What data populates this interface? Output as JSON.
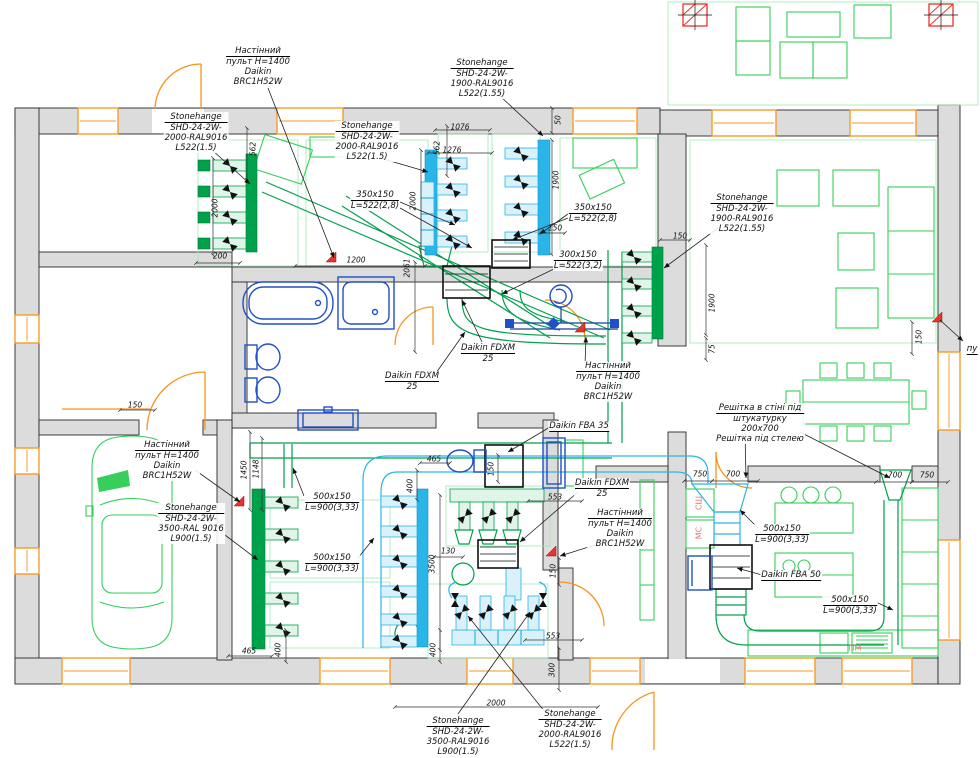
{
  "drawing": {
    "type": "hvac-floor-plan",
    "colors": {
      "wall": "#dcdcdc",
      "duct_green": "#00a14b",
      "furniture_green": "#35cf5a",
      "duct_cyan": "#2ab5e8",
      "sanitary_blue": "#2050c8",
      "window_orange": "#f7941d",
      "marker_red": "#e8342a",
      "label_pink": "#e87070"
    },
    "callouts": [
      {
        "x": 258,
        "y": 46,
        "lines": [
          "Настінний",
          "пульт H=1400",
          "Daikin",
          "BRC1H52W"
        ]
      },
      {
        "x": 196,
        "y": 112,
        "lines": [
          "Stonehange",
          "SHD-24-2W-",
          "2000-RAL9016",
          "L522(1.5)"
        ]
      },
      {
        "x": 367,
        "y": 121,
        "lines": [
          "Stonehange",
          "SHD-24-2W-",
          "2000-RAL9016",
          "L522(1.5)"
        ]
      },
      {
        "x": 482,
        "y": 58,
        "lines": [
          "Stonehange",
          "SHD-24-2W-",
          "1900-RAL9016",
          "L522(1.55)"
        ]
      },
      {
        "x": 375,
        "y": 190,
        "lines": [
          "350x150",
          "L=522(2,8)"
        ]
      },
      {
        "x": 742,
        "y": 193,
        "lines": [
          "Stonehange",
          "SHD-24-2W-",
          "1900-RAL9016",
          "L522(1.55)"
        ]
      },
      {
        "x": 593,
        "y": 203,
        "lines": [
          "350x150",
          "L=522(2,8)"
        ]
      },
      {
        "x": 578,
        "y": 250,
        "lines": [
          "300x150",
          "L=522(3,2)"
        ]
      },
      {
        "x": 488,
        "y": 343,
        "lines": [
          "Daikin FDXM",
          "25"
        ]
      },
      {
        "x": 412,
        "y": 371,
        "lines": [
          "Daikin FDXM",
          "25"
        ]
      },
      {
        "x": 608,
        "y": 361,
        "lines": [
          "Настінний",
          "пульт H=1400",
          "Daikin",
          "BRC1H52W"
        ]
      },
      {
        "x": 760,
        "y": 403,
        "lines": [
          "Решітка в стіні під",
          "штукатурку",
          "200х700",
          "Решітка під стелею"
        ]
      },
      {
        "x": 579,
        "y": 421,
        "lines": [
          "Daikin FBA 35"
        ]
      },
      {
        "x": 602,
        "y": 478,
        "lines": [
          "Daikin FDXM",
          "25"
        ]
      },
      {
        "x": 620,
        "y": 508,
        "lines": [
          "Настінний",
          "пульт H=1400",
          "Daikin",
          "BRC1H52W"
        ]
      },
      {
        "x": 167,
        "y": 440,
        "lines": [
          "Настінний",
          "пульт H=1400",
          "Daikin",
          "BRC1H52W"
        ]
      },
      {
        "x": 191,
        "y": 503,
        "lines": [
          "Stonehange",
          "SHD-24-2W-",
          "3500-RAL 9016",
          "L900(1.5)"
        ]
      },
      {
        "x": 332,
        "y": 492,
        "lines": [
          "500x150",
          "L=900(3,33)"
        ]
      },
      {
        "x": 332,
        "y": 553,
        "lines": [
          "500x150",
          "L=900(3,33)"
        ]
      },
      {
        "x": 782,
        "y": 524,
        "lines": [
          "500x150",
          "L=900(3,33)"
        ]
      },
      {
        "x": 791,
        "y": 570,
        "lines": [
          "Daikin FBA 50"
        ]
      },
      {
        "x": 850,
        "y": 595,
        "lines": [
          "500x150",
          "L=900(3,33)"
        ]
      },
      {
        "x": 458,
        "y": 716,
        "lines": [
          "Stonehange",
          "SHD-24-2W-",
          "3500-RAL9016",
          "L900(1.5)"
        ]
      },
      {
        "x": 570,
        "y": 709,
        "lines": [
          "Stonehange",
          "SHD-24-2W-",
          "2000-RAL9016",
          "L522(1.5)"
        ]
      },
      {
        "x": 972,
        "y": 344,
        "lines": [
          "пу"
        ]
      }
    ],
    "dims": [
      {
        "x": 253,
        "y": 149,
        "r": -90,
        "t": "562"
      },
      {
        "x": 215,
        "y": 208,
        "r": -90,
        "t": "2000"
      },
      {
        "x": 220,
        "y": 256,
        "r": 0,
        "t": "200"
      },
      {
        "x": 437,
        "y": 148,
        "r": -90,
        "t": "562"
      },
      {
        "x": 460,
        "y": 127,
        "r": 0,
        "t": "1076"
      },
      {
        "x": 452,
        "y": 150,
        "r": 0,
        "t": "1276"
      },
      {
        "x": 558,
        "y": 120,
        "r": -90,
        "t": "50"
      },
      {
        "x": 556,
        "y": 180,
        "r": -90,
        "t": "1900"
      },
      {
        "x": 555,
        "y": 228,
        "r": 0,
        "t": "150"
      },
      {
        "x": 356,
        "y": 260,
        "r": 0,
        "t": "1200"
      },
      {
        "x": 407,
        "y": 268,
        "r": -90,
        "t": "2061"
      },
      {
        "x": 413,
        "y": 201,
        "r": -90,
        "t": "2000"
      },
      {
        "x": 680,
        "y": 236,
        "r": 0,
        "t": "150"
      },
      {
        "x": 712,
        "y": 303,
        "r": -90,
        "t": "1900"
      },
      {
        "x": 712,
        "y": 349,
        "r": -90,
        "t": "75"
      },
      {
        "x": 919,
        "y": 337,
        "r": -90,
        "t": "150"
      },
      {
        "x": 135,
        "y": 405,
        "r": 0,
        "t": "150"
      },
      {
        "x": 244,
        "y": 470,
        "r": -90,
        "t": "1450"
      },
      {
        "x": 256,
        "y": 469,
        "r": -90,
        "t": "1148"
      },
      {
        "x": 434,
        "y": 459,
        "r": 0,
        "t": "465"
      },
      {
        "x": 410,
        "y": 486,
        "r": -90,
        "t": "400"
      },
      {
        "x": 491,
        "y": 469,
        "r": -90,
        "t": "150"
      },
      {
        "x": 555,
        "y": 497,
        "r": 0,
        "t": "553"
      },
      {
        "x": 448,
        "y": 551,
        "r": 0,
        "t": "130"
      },
      {
        "x": 432,
        "y": 564,
        "r": -90,
        "t": "3500"
      },
      {
        "x": 553,
        "y": 571,
        "r": -90,
        "t": "150"
      },
      {
        "x": 249,
        "y": 651,
        "r": 0,
        "t": "465"
      },
      {
        "x": 278,
        "y": 650,
        "r": -90,
        "t": "400"
      },
      {
        "x": 433,
        "y": 650,
        "r": -90,
        "t": "400"
      },
      {
        "x": 553,
        "y": 636,
        "r": 0,
        "t": "553"
      },
      {
        "x": 552,
        "y": 670,
        "r": -90,
        "t": "300"
      },
      {
        "x": 496,
        "y": 703,
        "r": 0,
        "t": "2000"
      },
      {
        "x": 700,
        "y": 474,
        "r": 0,
        "t": "750"
      },
      {
        "x": 733,
        "y": 474,
        "r": 0,
        "t": "700"
      },
      {
        "x": 895,
        "y": 475,
        "r": 0,
        "t": "700"
      },
      {
        "x": 927,
        "y": 475,
        "r": 0,
        "t": "750"
      }
    ],
    "room_labels": [
      {
        "x": 699,
        "y": 503,
        "r": -90,
        "t": "СШ",
        "color": "#e87070"
      },
      {
        "x": 699,
        "y": 533,
        "r": -90,
        "t": "МС",
        "color": "#e87070"
      },
      {
        "x": 855,
        "y": 648,
        "r": 0,
        "t": "ПМ",
        "color": "#e87070"
      }
    ]
  }
}
